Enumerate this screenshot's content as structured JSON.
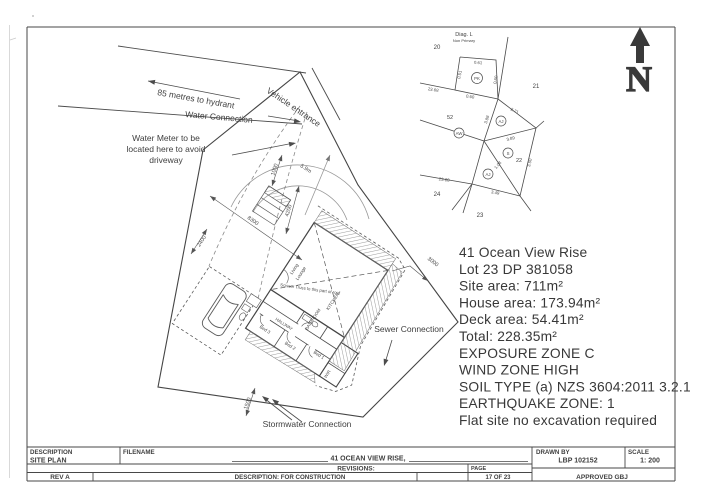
{
  "info": {
    "lines": [
      "41 Ocean View Rise",
      "Lot 23 DP 381058",
      "Site area: 711m²",
      "House area: 173.94m²",
      "Deck area: 54.41m²",
      "Total: 228.35m²",
      "EXPOSURE ZONE C",
      "WIND ZONE HIGH",
      "SOIL TYPE (a) NZS 3604:2011 3.2.1",
      "EARTHQUAKE ZONE: 1",
      "Flat site no excavation required"
    ]
  },
  "annotations": {
    "hydrant": "85 metres to hydrant",
    "water_connection": "Water Connection",
    "vehicle_entrance": "Vehicle entrance",
    "water_meter_1": "Water Meter to be",
    "water_meter_2": "located here to avoid",
    "water_meter_3": "driveway",
    "sewer": "Sewer Connection",
    "stormwater": "Stormwater Connection"
  },
  "dimensions": {
    "d1000": "1000",
    "d59": "5.9m",
    "d4200": "4200",
    "d8300": "8300",
    "d2400": "2400",
    "d3000": "3000",
    "d1500": "1500"
  },
  "house": {
    "living": "Living",
    "lounge": "Lounge",
    "kitchen": "KITCHEN",
    "bathroom": "BATHROOM",
    "hallway": "HALLWAY",
    "bed1": "Bed 1",
    "bed2": "Bed 2",
    "bed3": "Bed 3",
    "wir": "WIR",
    "truss": "Scissor Truss to this part of roof"
  },
  "north": {
    "letter": "N"
  },
  "survey": {
    "diag_title": "Diag. L",
    "diag_subtitle": "Non Primary",
    "parcels": {
      "p20": "20",
      "p21": "21",
      "p22": "22",
      "p23": "23",
      "p24": "24",
      "p52": "52"
    },
    "markers": {
      "pk": "PK",
      "aj_upper": "AJ",
      "s": "S",
      "aj_lower": "AJ",
      "aw": "AW"
    },
    "dims": {
      "d061": "0.61",
      "d051": "0.51",
      "d060a": "0.60",
      "d060b": "0.60",
      "d2368a": "23.68",
      "d271": "2.71",
      "d388": "3.88",
      "d389": "3.89",
      "d108": "1.08",
      "d350": "3.50",
      "d2368b": "23.68",
      "d349": "3.49"
    }
  },
  "titleblock": {
    "description_label": "DESCRIPTION",
    "description_value": "SITE PLAN",
    "filename_label": "FILENAME",
    "filename_value": "41 OCEAN VIEW RISE,",
    "revisions_label": "REVISIONS:",
    "rev_value": "REV A",
    "rev_description": "DESCRIPTION: FOR CONSTRUCTION",
    "page_label": "PAGE",
    "page_value": "17 OF 23",
    "drawnby_label": "DRAWN BY",
    "drawnby_value": "LBP 102152",
    "scale_label": "SCALE",
    "scale_value": "1: 200",
    "approved_value": "APPROVED GBJ"
  }
}
